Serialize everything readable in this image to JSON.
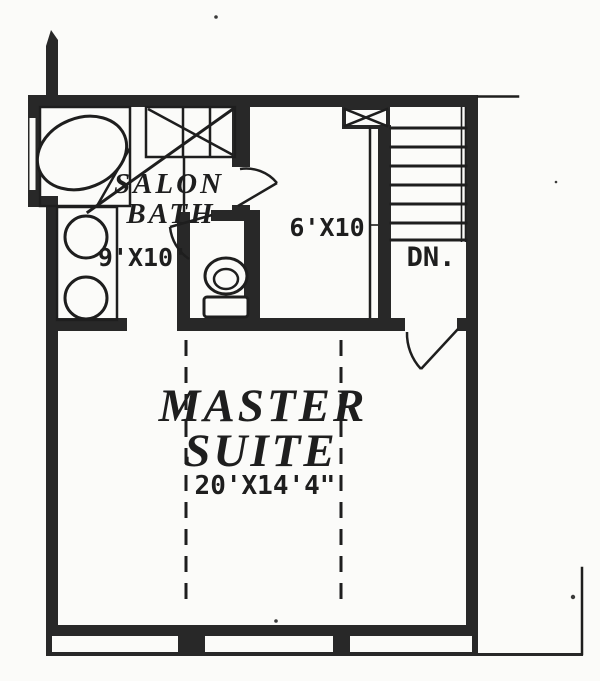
{
  "rooms": {
    "salon_bath": {
      "name_line1": "SALON",
      "name_line2": "BATH",
      "dimensions": "9'X10'"
    },
    "closet": {
      "dimensions": "6'X10"
    },
    "stairs": {
      "label": "DN."
    },
    "master_suite": {
      "name_line1": "MASTER",
      "name_line2": "SUITE",
      "dimensions": "20'X14'4\""
    }
  },
  "fixtures": [
    "bathtub",
    "shower-stall",
    "vanity-double-sinks",
    "toilet",
    "staircase-down",
    "door-swing-master-entry",
    "door-swing-closet",
    "door-swing-water-closet",
    "windows",
    "ceiling-break-dashed-lines"
  ],
  "colors": {
    "wall": "#282828",
    "line": "#1e1e1e",
    "text": "#1e1e1e",
    "paper": "#fbfbf9"
  }
}
